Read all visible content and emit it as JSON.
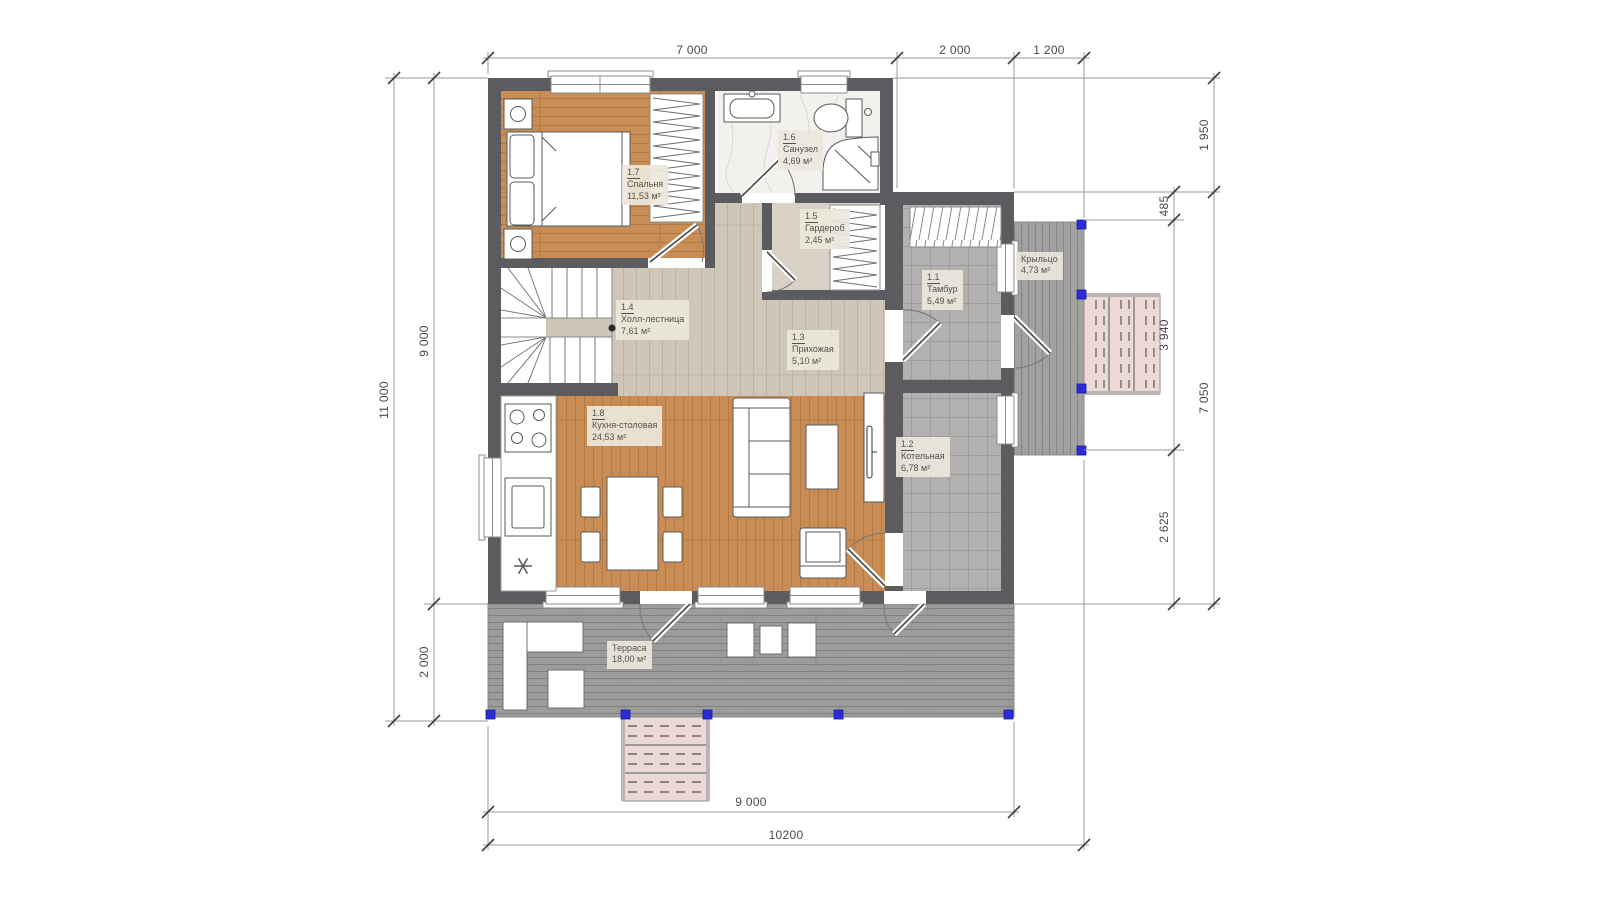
{
  "drawing": {
    "type": "architectural-floor-plan",
    "floor": "first",
    "units": "mm"
  },
  "rooms": [
    {
      "number": "1.7",
      "name": "Спальня",
      "area": "11,53 м²"
    },
    {
      "number": "1.6",
      "name": "Санузел",
      "area": "4,69 м²"
    },
    {
      "number": "1.5",
      "name": "Гардероб",
      "area": "2,45 м²"
    },
    {
      "number": "1.4",
      "name": "Холл-лестница",
      "area": "7,61 м²"
    },
    {
      "number": "1.3",
      "name": "Прихожая",
      "area": "5,10 м²"
    },
    {
      "number": "1.1",
      "name": "Тамбур",
      "area": "5,49 м²"
    },
    {
      "number": "1.2",
      "name": "Котельная",
      "area": "6,78 м²"
    },
    {
      "number": "1.8",
      "name": "Кухня-столовая",
      "area": "24,53 м²"
    },
    {
      "number": "",
      "name": "Терраса",
      "area": "18,00 м²"
    },
    {
      "number": "",
      "name": "Крыльцо",
      "area": "4,73 м²"
    }
  ],
  "dimensions": {
    "top": [
      "7 000",
      "2 000",
      "1 200"
    ],
    "left_outer": [
      "11 000"
    ],
    "left_inner": [
      "9 000",
      "2 000"
    ],
    "right_outer": [
      "1 950",
      "7 050"
    ],
    "right_inner": [
      "485",
      "3 940",
      "2 625"
    ],
    "bottom": [
      "9 000",
      "10200"
    ]
  },
  "colors": {
    "wall": "#5c5c60",
    "wood_floor": "#c88c54",
    "light_wood_floor": "#cfc6b8",
    "tile_floor": "#b2b1af",
    "deck": "#9c9c9a",
    "steps": "#ecd9d5",
    "marble": "#f3f1ee",
    "post_marker_blue": "#2b2bdc",
    "label_background": "#ede7db",
    "dimension_text": "#4a4a4a"
  }
}
